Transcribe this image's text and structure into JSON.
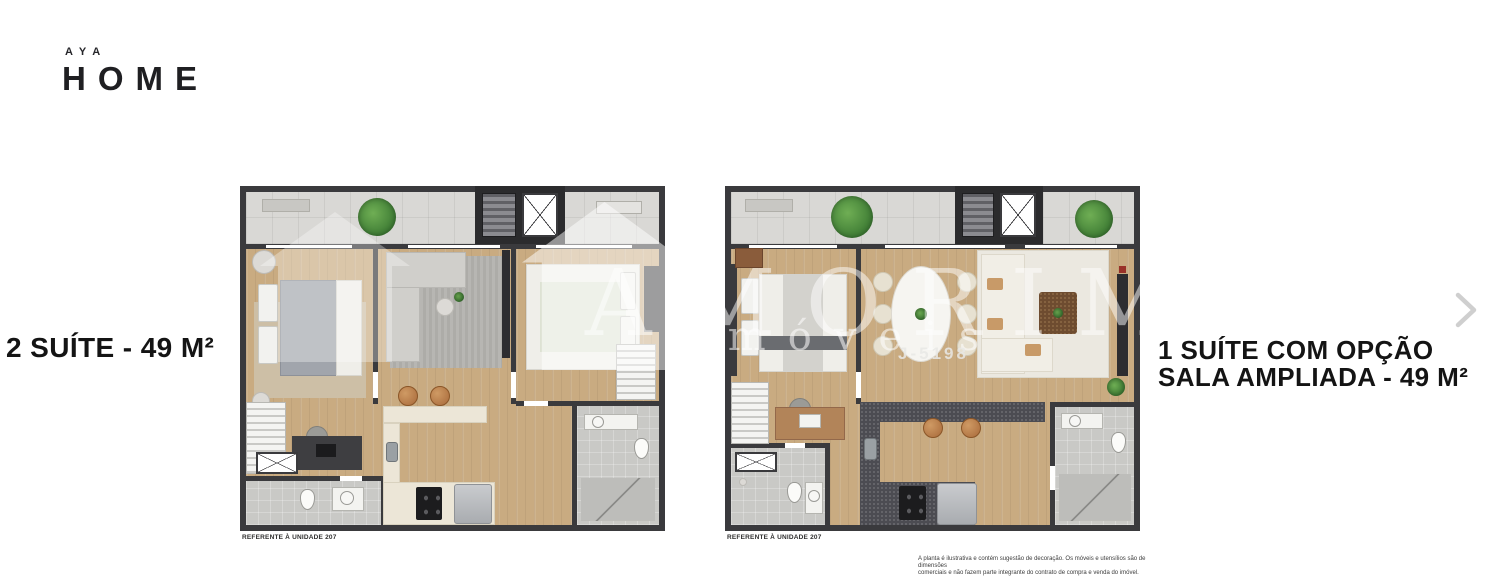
{
  "brand": {
    "top": "AYA",
    "main": "HOME"
  },
  "left_plan": {
    "title": "2 SUÍTE - 49 M²",
    "footnote": "REFERENTE À UNIDADE 207"
  },
  "right_plan": {
    "title_line1": "1 SUÍTE COM OPÇÃO",
    "title_line2": "SALA AMPLIADA - 49 M²",
    "footnote": "REFERENTE À UNIDADE 207"
  },
  "watermark": {
    "brand": "AMORIM",
    "sub": "Imóveis",
    "license": "J-5198"
  },
  "disclaimer": {
    "line1": "A planta é ilustrativa e contém sugestão de decoração. Os móveis e utensílios são de dimensões",
    "line2": "comerciais e não fazem parte integrante do contrato de compra e venda do imóvel."
  },
  "colors": {
    "wall": "#3a3a3d",
    "wood_floor": "#c9ab81",
    "balcony_tile": "#d9d8d5",
    "bath_tile": "#c9c9c6",
    "plant_green": "#4e9444",
    "kitchen_dark": "#4c4c52",
    "kitchen_cream": "#ece6d7",
    "watermark_white": "#ffffff"
  }
}
